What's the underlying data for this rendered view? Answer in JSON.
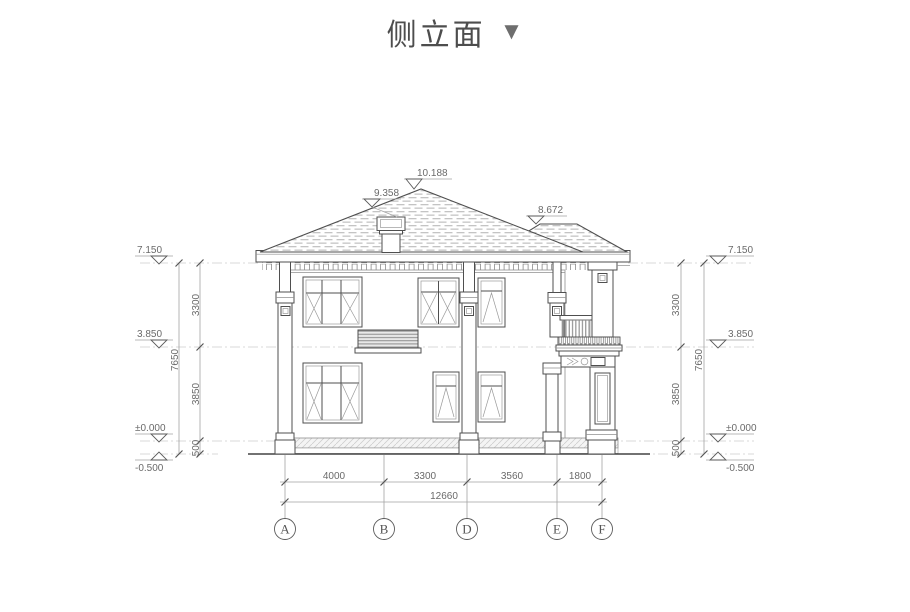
{
  "title": {
    "text": "侧立面",
    "collapse_icon": "▼"
  },
  "elevation_markers": {
    "ridge": "10.188",
    "left_slope": "9.358",
    "porch_roof": "8.672",
    "eave": "7.150",
    "second_floor": "3.850",
    "zero": "±0.000",
    "ground": "-0.500"
  },
  "vertical_dims": {
    "upper": "3300",
    "lower": "3850",
    "plinth": "500",
    "total": "7650"
  },
  "horizontal_dims": {
    "a_b": "4000",
    "b_d": "3300",
    "d_e": "3560",
    "e_f": "1800",
    "total": "12660"
  },
  "grid_axes": [
    "A",
    "B",
    "D",
    "E",
    "F"
  ],
  "colors": {
    "line_dark": "#4f4f4f",
    "line_light": "#cccccc",
    "roof_hatch": "#c4c4c4",
    "title_text": "#4d4d4d",
    "title_icon": "#6e6e6e"
  }
}
